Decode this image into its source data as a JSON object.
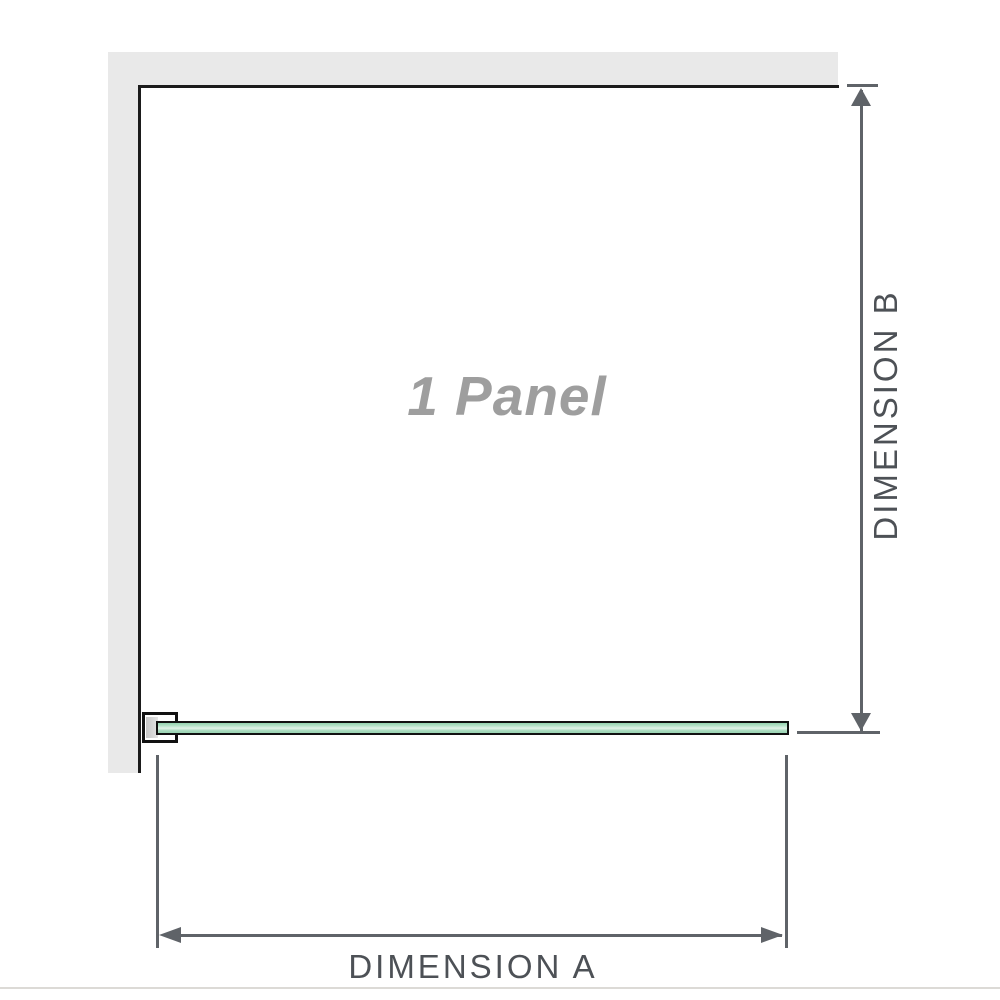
{
  "diagram": {
    "panel_label": "1 Panel",
    "dimension_a_label": "DIMENSION A",
    "dimension_b_label": "DIMENSION B"
  },
  "colors": {
    "wall_gray": "#e9e9e9",
    "edge_black": "#1b1b1b",
    "arrow_gray": "#5f6368",
    "label_gray": "#4d5156",
    "panel_text_gray": "#9e9e9e",
    "glass_green": "#93d2ae",
    "glass_green_light": "#e2f3e8",
    "glass_border": "#111111",
    "baseline_gray": "#dcdad6"
  }
}
